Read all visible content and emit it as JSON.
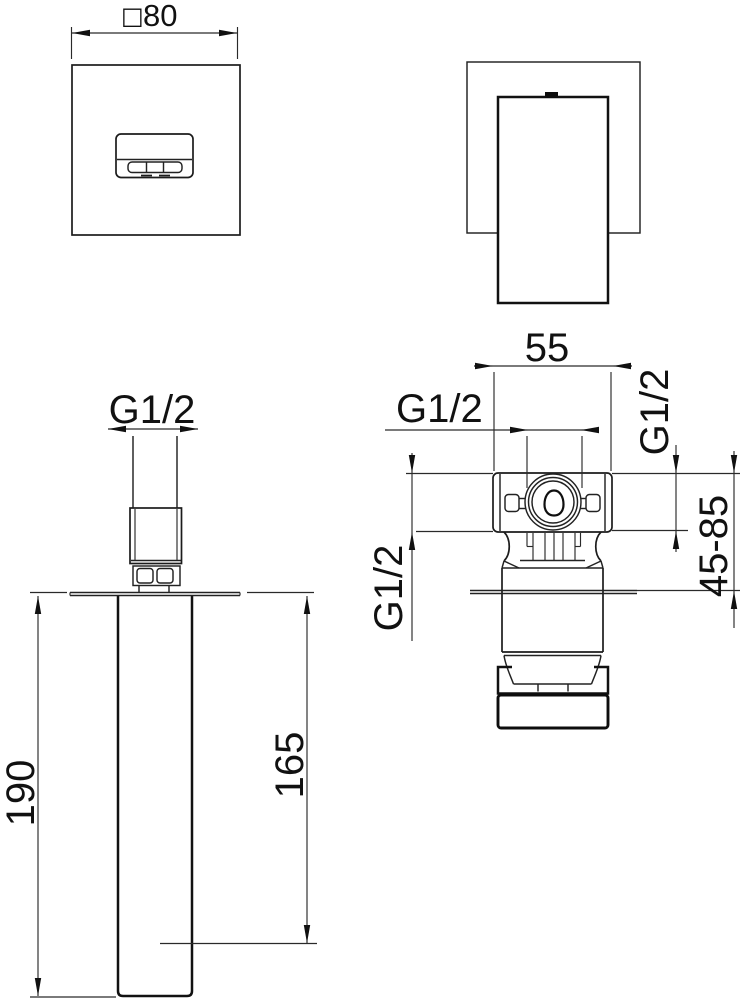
{
  "labels": {
    "front_width_symbol": "□",
    "front_width": "80",
    "spout_thread": "G1/2",
    "total_projection": "190",
    "spout_projection": "165",
    "valve_width": "55",
    "valve_top_thread": "G1/2",
    "valve_side_thread_left": "G1/2",
    "valve_side_thread_right": "G1/2",
    "mounting_depth_range": "45-85"
  }
}
